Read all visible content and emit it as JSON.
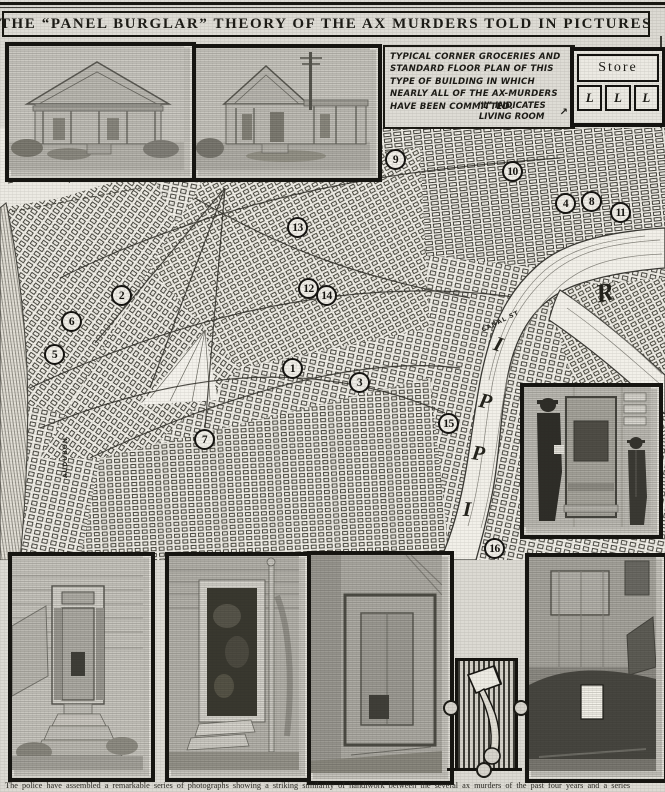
{
  "page": {
    "title": "THE “PANEL  BURGLAR” THEORY OF THE AX MURDERS TOLD IN PICTURES",
    "bottom_caption": "The police have assembled a remarkable series of photographs showing a striking similarity of handiwork between the several ax murders of the past four years and a series"
  },
  "caption_box": {
    "text": "TYPICAL CORNER GROCERIES AND STANDARD FLOOR PLAN OF THIS TYPE OF BUILDING IN WHICH NEARLY ALL OF THE AX-MURDERS HAVE BEEN COMMITTED.",
    "note": "“L” INDICATES LIVING ROOM"
  },
  "icons": {
    "arrow": "↗"
  },
  "floor_plan": {
    "store_label": "Store",
    "living_room_labels": [
      "L",
      "L",
      "L"
    ]
  },
  "map": {
    "canal_label": "CANAL ST",
    "park_label": "AUDUBON",
    "river_letters": [
      {
        "ch": "R",
        "x": 596,
        "y": 278,
        "rot": -12,
        "size": 26
      },
      {
        "ch": "I",
        "x": 494,
        "y": 332,
        "rot": 18,
        "size": 21
      },
      {
        "ch": "P",
        "x": 479,
        "y": 389,
        "rot": 12,
        "size": 21
      },
      {
        "ch": "P",
        "x": 472,
        "y": 441,
        "rot": 8,
        "size": 21
      },
      {
        "ch": "I",
        "x": 463,
        "y": 497,
        "rot": 3,
        "size": 21
      }
    ],
    "markers": [
      {
        "n": "1",
        "x": 293,
        "y": 369
      },
      {
        "n": "2",
        "x": 122,
        "y": 296
      },
      {
        "n": "3",
        "x": 360,
        "y": 383
      },
      {
        "n": "4",
        "x": 566,
        "y": 204
      },
      {
        "n": "5",
        "x": 55,
        "y": 355
      },
      {
        "n": "6",
        "x": 72,
        "y": 322
      },
      {
        "n": "7",
        "x": 205,
        "y": 440
      },
      {
        "n": "8",
        "x": 592,
        "y": 202
      },
      {
        "n": "9",
        "x": 396,
        "y": 160
      },
      {
        "n": "10",
        "x": 513,
        "y": 172
      },
      {
        "n": "11",
        "x": 621,
        "y": 213
      },
      {
        "n": "12",
        "x": 309,
        "y": 289
      },
      {
        "n": "13",
        "x": 298,
        "y": 228
      },
      {
        "n": "14",
        "x": 327,
        "y": 296
      },
      {
        "n": "15",
        "x": 449,
        "y": 424
      },
      {
        "n": "16",
        "x": 495,
        "y": 549
      }
    ]
  }
}
